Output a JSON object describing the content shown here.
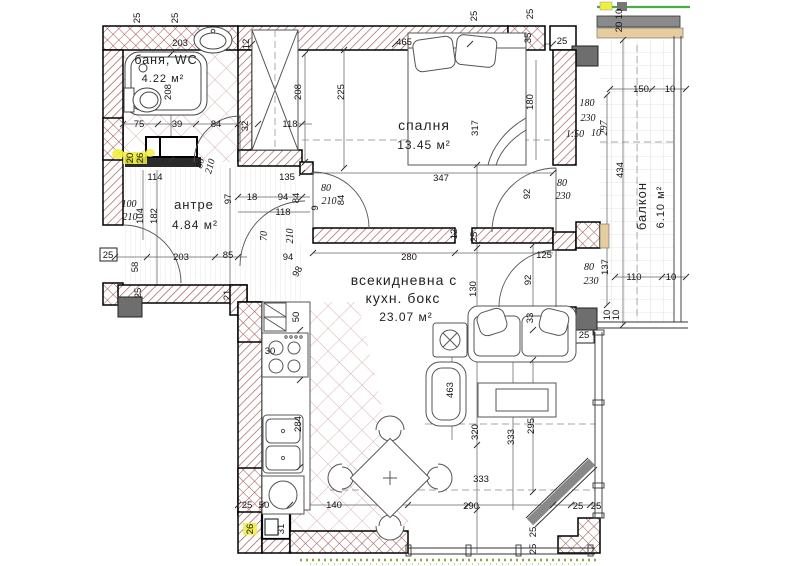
{
  "rooms": {
    "bathroom": {
      "name": "баня, WC",
      "area": "4.22 м²"
    },
    "bedroom": {
      "name": "спалня",
      "area": "13.45 м²"
    },
    "hallway": {
      "name": "антре",
      "area": "4.84 м²"
    },
    "living": {
      "name_line1": "всекидневна с",
      "name_line2": "кухн. бокс",
      "area": "23.07 м²"
    },
    "balcony": {
      "name": "балкон",
      "area": "6.10 м²"
    }
  },
  "colors": {
    "wall_hatch": "#a05050",
    "tile": "#d8aeae",
    "column_gray": "#6e6e6e",
    "tan_parapet": "#e6cd9e",
    "accent_green": "#43b049",
    "highlight_yellow": "#f2ee3e",
    "grass_green": "#7fae3e"
  },
  "dimensions": [
    {
      "t": "25",
      "x": 140,
      "y": 18,
      "r": -90
    },
    {
      "t": "25",
      "x": 178,
      "y": 18,
      "r": -90
    },
    {
      "t": "203",
      "x": 180,
      "y": 46
    },
    {
      "t": "12",
      "x": 249,
      "y": 44,
      "r": -90
    },
    {
      "t": "465",
      "x": 404,
      "y": 45
    },
    {
      "t": "25",
      "x": 477,
      "y": 16,
      "r": -90
    },
    {
      "t": "25",
      "x": 533,
      "y": 14,
      "r": -90
    },
    {
      "t": "35",
      "x": 531,
      "y": 38,
      "r": -90
    },
    {
      "t": "25",
      "x": 562,
      "y": 44
    },
    {
      "t": "10",
      "x": 622,
      "y": 14,
      "r": -90
    },
    {
      "t": "20",
      "x": 622,
      "y": 27,
      "r": -90
    },
    {
      "t": "75",
      "x": 139,
      "y": 127
    },
    {
      "t": "39",
      "x": 177,
      "y": 127
    },
    {
      "t": "84",
      "x": 216,
      "y": 127
    },
    {
      "t": "32",
      "x": 248,
      "y": 126,
      "r": -90
    },
    {
      "t": "118",
      "x": 290,
      "y": 127
    },
    {
      "t": "208",
      "x": 171,
      "y": 92,
      "r": -90
    },
    {
      "t": "208",
      "x": 301,
      "y": 92,
      "r": -90
    },
    {
      "t": "225",
      "x": 344,
      "y": 92,
      "r": -90
    },
    {
      "t": "135",
      "x": 287,
      "y": 180
    },
    {
      "t": "20",
      "x": 133,
      "y": 158,
      "r": -90,
      "hl": true
    },
    {
      "t": "26",
      "x": 143,
      "y": 158,
      "r": -90,
      "hl": true
    },
    {
      "t": "114",
      "x": 155,
      "y": 180
    },
    {
      "t": "317",
      "x": 478,
      "y": 128,
      "r": -90
    },
    {
      "t": "180",
      "x": 533,
      "y": 102,
      "r": -90
    },
    {
      "t": "347",
      "x": 441,
      "y": 181
    },
    {
      "t": "92",
      "x": 530,
      "y": 194,
      "r": -90
    },
    {
      "t": "80",
      "x": 562,
      "y": 186,
      "i": true
    },
    {
      "t": "230",
      "x": 563,
      "y": 199,
      "i": true
    },
    {
      "t": "150",
      "x": 641,
      "y": 92
    },
    {
      "t": "10",
      "x": 670,
      "y": 92
    },
    {
      "t": "180",
      "x": 587,
      "y": 106,
      "i": true
    },
    {
      "t": "230",
      "x": 588,
      "y": 121,
      "i": true
    },
    {
      "t": "1:50",
      "x": 575,
      "y": 137,
      "i": true,
      "s": 6.5
    },
    {
      "t": "10",
      "x": 596,
      "y": 136,
      "i": true
    },
    {
      "t": "297",
      "x": 607,
      "y": 128,
      "r": -90,
      "i": true
    },
    {
      "t": "434",
      "x": 623,
      "y": 170,
      "r": -90
    },
    {
      "t": "137",
      "x": 608,
      "y": 267,
      "r": -90
    },
    {
      "t": "110",
      "x": 634,
      "y": 280
    },
    {
      "t": "10",
      "x": 671,
      "y": 280
    },
    {
      "t": "10",
      "x": 610,
      "y": 315,
      "r": -90
    },
    {
      "t": "10",
      "x": 619,
      "y": 315,
      "r": -90
    },
    {
      "t": "100",
      "x": 129,
      "y": 207,
      "i": true
    },
    {
      "t": "210",
      "x": 130,
      "y": 220,
      "i": true
    },
    {
      "t": "104",
      "x": 143,
      "y": 216,
      "r": -90
    },
    {
      "t": "182",
      "x": 157,
      "y": 216,
      "r": -90
    },
    {
      "t": "97",
      "x": 231,
      "y": 199,
      "r": -90
    },
    {
      "t": "18",
      "x": 252,
      "y": 200
    },
    {
      "t": "94",
      "x": 283,
      "y": 200
    },
    {
      "t": "84",
      "x": 299,
      "y": 198,
      "r": -90
    },
    {
      "t": "118",
      "x": 283,
      "y": 215
    },
    {
      "t": "80",
      "x": 203,
      "y": 164,
      "r": -75,
      "i": true
    },
    {
      "t": "210",
      "x": 213,
      "y": 167,
      "r": -75,
      "i": true
    },
    {
      "t": "80",
      "x": 326,
      "y": 191,
      "i": true
    },
    {
      "t": "210",
      "x": 329,
      "y": 204,
      "i": true
    },
    {
      "t": "9",
      "x": 318,
      "y": 208,
      "r": -90
    },
    {
      "t": "84",
      "x": 344,
      "y": 200,
      "r": -90
    },
    {
      "t": "70",
      "x": 267,
      "y": 236,
      "r": -90,
      "i": true
    },
    {
      "t": "210",
      "x": 293,
      "y": 236,
      "r": -90,
      "i": true
    },
    {
      "t": "94",
      "x": 288,
      "y": 260
    },
    {
      "t": "98",
      "x": 300,
      "y": 273,
      "r": -60
    },
    {
      "t": "25",
      "x": 108,
      "y": 258
    },
    {
      "t": "58",
      "x": 138,
      "y": 267,
      "r": -90
    },
    {
      "t": "203",
      "x": 181,
      "y": 260
    },
    {
      "t": "85",
      "x": 228,
      "y": 258
    },
    {
      "t": "25",
      "x": 141,
      "y": 293,
      "r": -90
    },
    {
      "t": "21",
      "x": 230,
      "y": 295,
      "r": -90
    },
    {
      "t": "280",
      "x": 409,
      "y": 260
    },
    {
      "t": "12",
      "x": 457,
      "y": 234,
      "r": -90
    },
    {
      "t": "25",
      "x": 477,
      "y": 237,
      "r": -90
    },
    {
      "t": "130",
      "x": 476,
      "y": 289,
      "r": -90
    },
    {
      "t": "125",
      "x": 544,
      "y": 258
    },
    {
      "t": "92",
      "x": 531,
      "y": 280,
      "r": -90
    },
    {
      "t": "80",
      "x": 589,
      "y": 270,
      "i": true
    },
    {
      "t": "230",
      "x": 591,
      "y": 284,
      "i": true
    },
    {
      "t": "33",
      "x": 533,
      "y": 318,
      "r": -90
    },
    {
      "t": "25",
      "x": 584,
      "y": 338
    },
    {
      "t": "50",
      "x": 299,
      "y": 317,
      "r": -90
    },
    {
      "t": "30",
      "x": 270,
      "y": 354
    },
    {
      "t": "284",
      "x": 301,
      "y": 424,
      "r": -90
    },
    {
      "t": "463",
      "x": 453,
      "y": 390,
      "r": -90
    },
    {
      "t": "320",
      "x": 478,
      "y": 432,
      "r": -90
    },
    {
      "t": "333",
      "x": 514,
      "y": 437,
      "r": -90
    },
    {
      "t": "295",
      "x": 534,
      "y": 426,
      "r": -90
    },
    {
      "t": "333",
      "x": 481,
      "y": 482
    },
    {
      "t": "290",
      "x": 471,
      "y": 509
    },
    {
      "t": "25",
      "x": 247,
      "y": 508
    },
    {
      "t": "50",
      "x": 264,
      "y": 508
    },
    {
      "t": "140",
      "x": 334,
      "y": 508
    },
    {
      "t": "25",
      "x": 578,
      "y": 509
    },
    {
      "t": "25",
      "x": 596,
      "y": 509
    },
    {
      "t": "26",
      "x": 253,
      "y": 529,
      "r": -90,
      "hl": true
    },
    {
      "t": "31",
      "x": 284,
      "y": 529,
      "r": -90
    },
    {
      "t": "25",
      "x": 536,
      "y": 532,
      "r": -90
    },
    {
      "t": "25",
      "x": 536,
      "y": 549,
      "r": -90
    }
  ]
}
